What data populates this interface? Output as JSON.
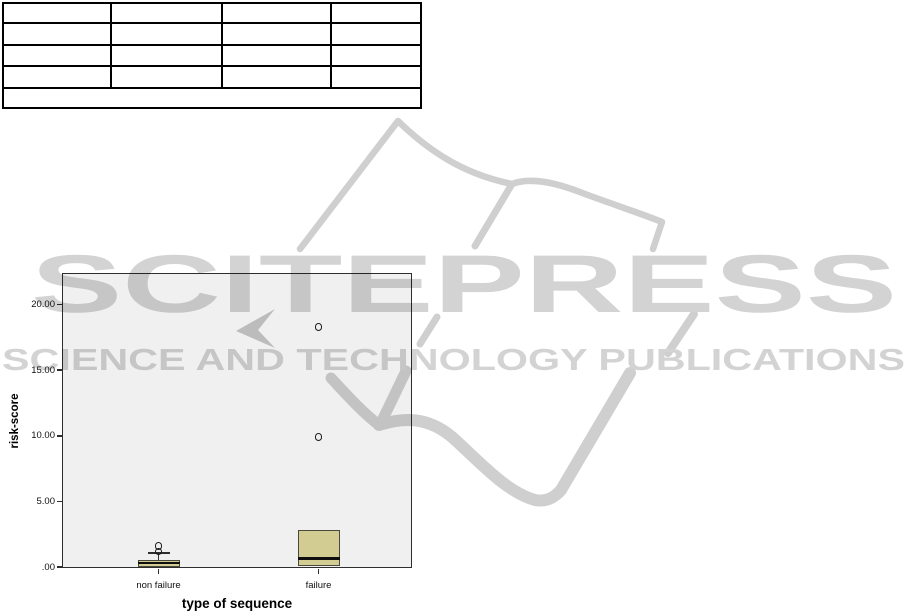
{
  "page": {
    "background": "#ffffff"
  },
  "table": {
    "rows": [
      [
        "",
        "",
        "",
        ""
      ],
      [
        "",
        "",
        "",
        ""
      ],
      [
        "",
        "",
        "",
        ""
      ],
      [
        "",
        "",
        "",
        ""
      ]
    ],
    "footer_row": ""
  },
  "watermark": {
    "title": "SCITEPRESS",
    "subtitle": "SCIENCE AND TECHNOLOGY PUBLICATIONS",
    "color": "#d3d3d3",
    "accent_color": "#c8c8c8"
  },
  "chart_data": {
    "type": "boxplot",
    "title": "",
    "xlabel": "type of sequence",
    "ylabel": "risk-score",
    "categories": [
      "non failure",
      "failure"
    ],
    "y_ticks": [
      {
        "label": ".00",
        "value": 0
      },
      {
        "label": "5.00",
        "value": 5
      },
      {
        "label": "10.00",
        "value": 10
      },
      {
        "label": "15.00",
        "value": 15
      },
      {
        "label": "20.00",
        "value": 20
      }
    ],
    "ylim": [
      0,
      22.4
    ],
    "grid": false,
    "legend": "none",
    "groups": [
      {
        "category": "non failure",
        "q1": 0.0,
        "median": 0.3,
        "q3": 0.5,
        "whisker_low": null,
        "whisker_high": 1.05,
        "outliers": [
          1.2,
          1.6
        ]
      },
      {
        "category": "failure",
        "q1": 0.05,
        "median": 0.65,
        "q3": 2.85,
        "whisker_low": null,
        "whisker_high": null,
        "outliers": [
          9.9,
          18.3
        ]
      }
    ],
    "plot_bg": "#f0f0f0",
    "box_fill": "#d2cc93"
  }
}
